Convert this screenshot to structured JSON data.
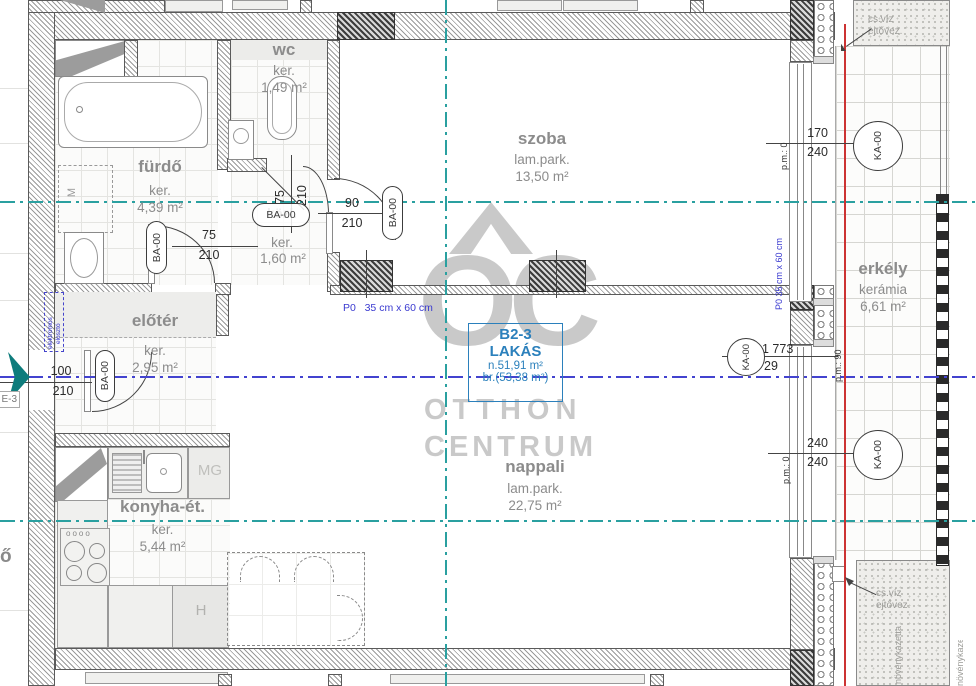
{
  "unit_box": {
    "code": "B2-3",
    "word": "LAKÁS",
    "net": "n.51,91 m²",
    "gross": "br.(53,38 m²)"
  },
  "watermark": {
    "monogram": "OC",
    "top": "OTTHON",
    "bottom": "CENTRUM"
  },
  "rooms": [
    {
      "name": "fürdő",
      "floor": "ker.",
      "area": "4,39 m²"
    },
    {
      "name": "wc",
      "floor": "ker.",
      "area": "1,49 m²"
    },
    {
      "name": "közl.",
      "floor": "ker.",
      "area": "1,60 m²"
    },
    {
      "name": "szoba",
      "floor": "lam.park.",
      "area": "13,50 m²"
    },
    {
      "name": "előtér",
      "floor": "ker.",
      "area": "2,95 m²"
    },
    {
      "name": "konyha-ét.",
      "floor": "ker.",
      "area": "5,44 m²"
    },
    {
      "name": "nappali",
      "floor": "lam.park.",
      "area": "22,75 m²"
    },
    {
      "name": "erkély",
      "floor": "kerámia",
      "area": "6,61 m²"
    }
  ],
  "tags": {
    "door": "BA-00",
    "window": "KA-00"
  },
  "dims": {
    "door_furdo_w": "75",
    "door_furdo_h": "210",
    "door_wc_w": "75",
    "door_wc_h": "210",
    "door_szoba_w": "90",
    "door_szoba_h": "210",
    "door_entry_w": "100",
    "door_entry_h": "210",
    "win_top_w": "170",
    "win_top_h": "240",
    "win_mid_w": "1 773",
    "win_mid_h": "29",
    "win_bot_w": "240",
    "win_bot_h": "240"
  },
  "annotations": {
    "p0": "P0   35 cm x 60 cm",
    "p0_v": "P0 35 cm x 60 cm",
    "pm0": "p.m.: 0",
    "pm90": "p.m.: 90",
    "elektromos1": "elektromos",
    "elektromos2": "elosztó",
    "entry_tag": "E-3",
    "csviz1": "cs.víz",
    "csviz2": "ejtővez.",
    "noveny": "növénykazetta",
    "washer": "M",
    "mg": "MG",
    "fridge": "H",
    "clipped": "ő"
  }
}
